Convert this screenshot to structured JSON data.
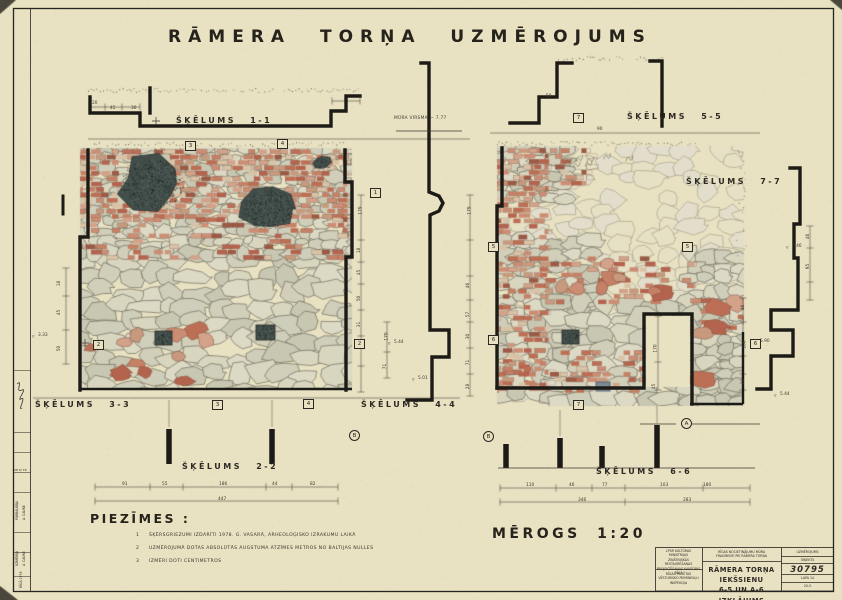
{
  "title": "RĀMERA TORŅA UZMĒROJUMS",
  "scale_label": "MĒROGS 1:20",
  "elev_note": "MŪRA VIRSMA — 7.77",
  "sections": [
    {
      "id": "1-1",
      "label": "ŠĶĒLUMS 1-1",
      "x": 176,
      "y": 116
    },
    {
      "id": "5-5",
      "label": "ŠĶĒLUMS 5-5",
      "x": 627,
      "y": 112
    },
    {
      "id": "7-7",
      "label": "ŠĶĒLUMS 7-7",
      "x": 686,
      "y": 177
    },
    {
      "id": "3-3",
      "label": "ŠĶĒLUMS 3-3",
      "x": 35,
      "y": 400
    },
    {
      "id": "4-4",
      "label": "ŠĶĒLUMS 4-4",
      "x": 361,
      "y": 400
    },
    {
      "id": "2-2",
      "label": "ŠĶĒLUMS 2-2",
      "x": 182,
      "y": 462
    },
    {
      "id": "6-6",
      "label": "ŠĶĒLUMS 6-6",
      "x": 596,
      "y": 467
    }
  ],
  "notes": {
    "heading": "PIEZĪMES :",
    "items": [
      {
        "num": "1",
        "text": "ŠĶĒRSGRIEZUMI IZDARĪTI 1978. G. VASARĀ, ARHEOLOĢISKO IZRAKUMU LAIKĀ"
      },
      {
        "num": "2",
        "text": "UZMĒROJUMĀ DOTAS ABSOLŪTĀS AUGSTUMA ATZĪMES METROS NO BALTIJAS NULLES"
      },
      {
        "num": "3",
        "text": "IZMĒRI DOTI CENTIMETROS"
      }
    ]
  },
  "dims": [
    {
      "t": "20",
      "x": 92,
      "y": 101
    },
    {
      "t": "45",
      "x": 110,
      "y": 106
    },
    {
      "t": "30",
      "x": 131,
      "y": 106
    },
    {
      "t": "50",
      "x": 546,
      "y": 94
    },
    {
      "t": "90",
      "x": 597,
      "y": 127
    },
    {
      "t": "3.33",
      "x": 38,
      "y": 333,
      "m": 1
    },
    {
      "t": "18",
      "x": 57,
      "y": 281,
      "r": 1
    },
    {
      "t": "45",
      "x": 57,
      "y": 310,
      "r": 1
    },
    {
      "t": "50",
      "x": 57,
      "y": 346,
      "r": 1
    },
    {
      "t": "179",
      "x": 357,
      "y": 208,
      "r": 1
    },
    {
      "t": "18",
      "x": 357,
      "y": 248,
      "r": 1
    },
    {
      "t": "45",
      "x": 357,
      "y": 270,
      "r": 1
    },
    {
      "t": "50",
      "x": 357,
      "y": 296,
      "r": 1
    },
    {
      "t": "31",
      "x": 357,
      "y": 322,
      "r": 1
    },
    {
      "t": "170",
      "x": 383,
      "y": 334,
      "r": 1
    },
    {
      "t": "71",
      "x": 383,
      "y": 364,
      "r": 1
    },
    {
      "t": "5.44",
      "x": 394,
      "y": 340,
      "m": 1
    },
    {
      "t": "5.01",
      "x": 418,
      "y": 376,
      "m": 1
    },
    {
      "t": "179",
      "x": 466,
      "y": 208,
      "r": 1
    },
    {
      "t": "46",
      "x": 466,
      "y": 283,
      "r": 1
    },
    {
      "t": "57",
      "x": 466,
      "y": 312,
      "r": 1
    },
    {
      "t": "30",
      "x": 466,
      "y": 334,
      "r": 1
    },
    {
      "t": "71",
      "x": 466,
      "y": 360,
      "r": 1
    },
    {
      "t": "28",
      "x": 466,
      "y": 384,
      "r": 1
    },
    {
      "t": "170",
      "x": 652,
      "y": 346,
      "r": 1
    },
    {
      "t": "45",
      "x": 652,
      "y": 384,
      "r": 1
    },
    {
      "t": "46",
      "x": 741,
      "y": 305,
      "r": 1
    },
    {
      "t": "100",
      "x": 741,
      "y": 342,
      "r": 1
    },
    {
      "t": "28",
      "x": 741,
      "y": 379,
      "r": 1
    },
    {
      "t": "46",
      "x": 806,
      "y": 234,
      "r": 1
    },
    {
      "t": "95",
      "x": 806,
      "y": 264,
      "r": 1
    },
    {
      "t": "6.46",
      "x": 792,
      "y": 244,
      "m": 1
    },
    {
      "t": "5.90",
      "x": 760,
      "y": 339,
      "m": 1
    },
    {
      "t": "5.44",
      "x": 780,
      "y": 392,
      "m": 1
    },
    {
      "t": "91",
      "x": 122,
      "y": 482
    },
    {
      "t": "55",
      "x": 162,
      "y": 482
    },
    {
      "t": "186",
      "x": 219,
      "y": 482
    },
    {
      "t": "44",
      "x": 272,
      "y": 482
    },
    {
      "t": "82",
      "x": 310,
      "y": 482
    },
    {
      "t": "447",
      "x": 218,
      "y": 497
    },
    {
      "t": "110",
      "x": 526,
      "y": 483
    },
    {
      "t": "46",
      "x": 569,
      "y": 483
    },
    {
      "t": "77",
      "x": 602,
      "y": 483
    },
    {
      "t": "103",
      "x": 660,
      "y": 483
    },
    {
      "t": "180",
      "x": 703,
      "y": 483
    },
    {
      "t": "346",
      "x": 578,
      "y": 498
    },
    {
      "t": "283",
      "x": 683,
      "y": 498
    }
  ],
  "markers_boxed": [
    {
      "t": "3",
      "x": 185,
      "y": 141
    },
    {
      "t": "4",
      "x": 277,
      "y": 139
    },
    {
      "t": "1",
      "x": 370,
      "y": 188
    },
    {
      "t": "2",
      "x": 354,
      "y": 339
    },
    {
      "t": "2",
      "x": 93,
      "y": 340
    },
    {
      "t": "5",
      "x": 488,
      "y": 242
    },
    {
      "t": "5",
      "x": 682,
      "y": 242
    },
    {
      "t": "6",
      "x": 488,
      "y": 335
    },
    {
      "t": "6",
      "x": 750,
      "y": 339
    },
    {
      "t": "7",
      "x": 573,
      "y": 113
    },
    {
      "t": "7",
      "x": 573,
      "y": 400
    },
    {
      "t": "3",
      "x": 212,
      "y": 400
    },
    {
      "t": "4",
      "x": 303,
      "y": 399
    }
  ],
  "markers_circled": [
    {
      "t": "B",
      "x": 349,
      "y": 430
    },
    {
      "t": "B",
      "x": 483,
      "y": 431
    },
    {
      "t": "A",
      "x": 681,
      "y": 418
    }
  ],
  "margin": {
    "rows": [
      {
        "t": "PĀRBAUDĪJA",
        "x": 15,
        "y": 520
      },
      {
        "t": "A. CAUNE",
        "x": 22,
        "y": 520
      },
      {
        "t": "UZMĒRĪJA",
        "x": 15,
        "y": 566
      },
      {
        "t": "A. CAUNE",
        "x": 22,
        "y": 566
      },
      {
        "t": "RĪGĀ 1978",
        "x": 19,
        "y": 588
      }
    ],
    "date": "28 IV 78"
  },
  "title_block": {
    "org1": "LPSR KULTŪRAS MINISTRIJAS\nZINĀTNISKĀS RESTAURĒŠANAS\nPROJEKTĒŠANAS KANTORIS\nRĪGĀ",
    "org2": "RĪGAS PILSĒTAS\nVĒSTURISKO PIEMINEKĻU\nINSPEKCIJA",
    "project": "RĪGAS NOCIETINĀJUMU MŪRA\nFRAGMENTI PIE RĀMERA TORŅA",
    "sheet_title": "RĀMERA TORŅA IEKŠSIENU\n6-5 UN A-6 IZKLĀJUMS",
    "doc_type": "UZMĒROJUMS",
    "object_label": "OBJEKTS",
    "object_no": "30795",
    "sheet_label": "LAPA 14",
    "code": "20-5"
  },
  "colors": {
    "paper": "#e8e1c2",
    "ink": "#26241e",
    "thin": "#3c3831",
    "brick": [
      "#c58166",
      "#bd6f55",
      "#cb8d74",
      "#d3a289",
      "#b4644e",
      "#c79a7e"
    ],
    "brick_light": "#d9c3a6",
    "stone": [
      "#d9d6c0",
      "#d1cfb9",
      "#c8c7b2",
      "#dcd9c5",
      "#cfceba"
    ],
    "stone_pale": "#e3decb",
    "paper_light": "#e6e0c4",
    "stone_outline": "#6e6b5b",
    "stone_outline_light": "#8f8b76",
    "dark_void": "#424e4a",
    "blue_block": "#7a8a96"
  }
}
